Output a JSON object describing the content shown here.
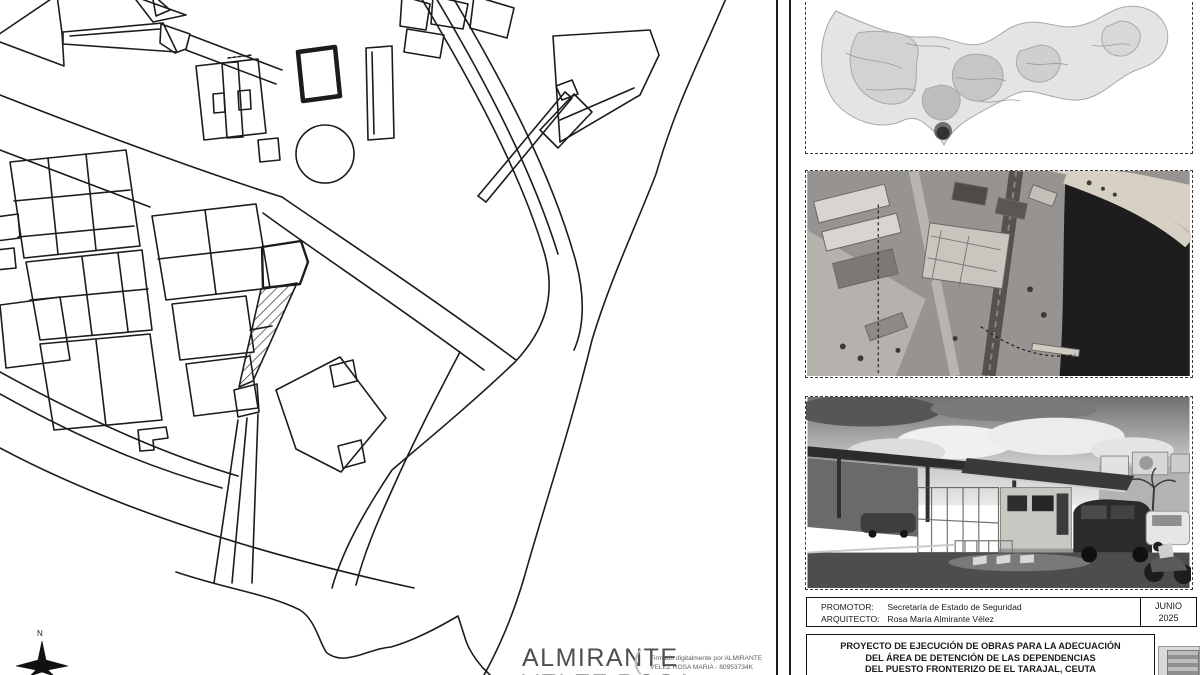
{
  "sheet": {
    "plan": {
      "compass_north_label": "N"
    },
    "signature": {
      "big_line1": "ALMIRANTE",
      "big_line2": "VELEZ ROSA",
      "small_line1": "Firmado digitalmente por ALMIRANTE",
      "small_line2": "VELEZ ROSA MARIA - 80953734K"
    },
    "title_block": {
      "promotor_label": "PROMOTOR:",
      "promotor_value": "Secretaría de Estado de Seguridad",
      "arquitecto_label": "ARQUITECTO:",
      "arquitecto_value": "Rosa María Almirante Vélez",
      "date_month": "JUNIO",
      "date_year": "2025",
      "project_line1": "PROYECTO DE EJECUCIÓN DE OBRAS PARA LA ADECUACIÓN",
      "project_line2": "DEL ÁREA DE DETENCIÓN DE LAS DEPENDENCIAS",
      "project_line3": "DEL PUESTO FRONTERIZO DE EL TARAJAL, CEUTA",
      "stamp_label": "Obra"
    },
    "colors": {
      "line": "#1c1c1c",
      "water": "#1d1d1d",
      "hatch": "#333333",
      "gray_text": "#4f4f4f"
    }
  }
}
